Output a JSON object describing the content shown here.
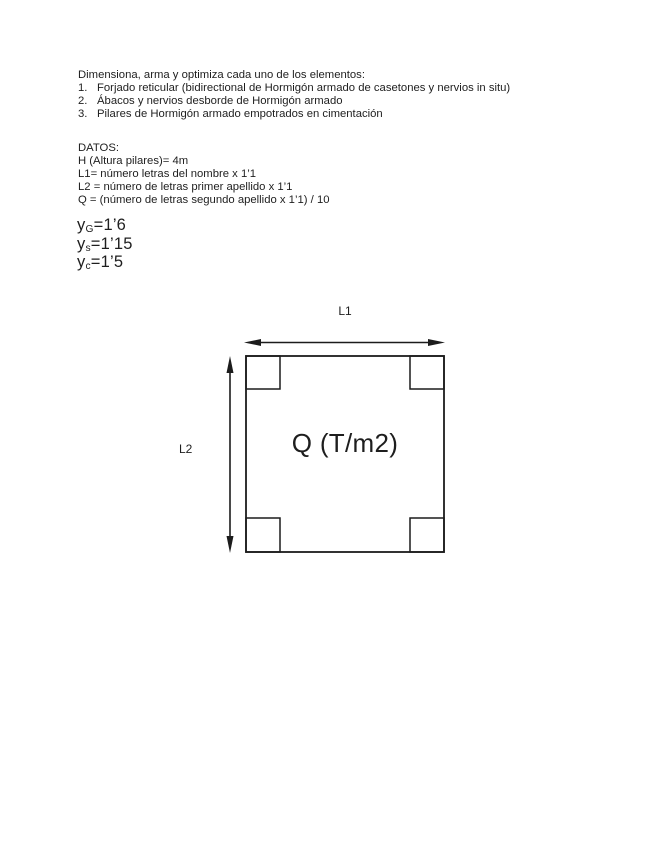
{
  "document": {
    "intro": "Dimensiona, arma y optimiza cada uno de los elementos:",
    "list": [
      {
        "marker": "1.",
        "text": "Forjado reticular (bidirectional de Hormigón armado de casetones y nervios in situ)"
      },
      {
        "marker": "2.",
        "text": "Ábacos y nervios desborde de Hormigón armado"
      },
      {
        "marker": "3.",
        "text": "Pilares de Hormigón armado empotrados en cimentación"
      }
    ],
    "datos_title": "DATOS:",
    "datos_lines": [
      "H (Altura pilares)= 4m",
      "L1= número letras del nombre x 1’1",
      "L2 = número de letras primer apellido x 1’1",
      "Q = (número de letras segundo apellido x 1’1) / 10"
    ],
    "safety_factors": [
      {
        "symbol": "y",
        "sub": "G",
        "value": "=1’6"
      },
      {
        "symbol": "y",
        "sub": "s",
        "value": "=1’15"
      },
      {
        "symbol": "y",
        "sub": "c",
        "value": "=1’5"
      }
    ],
    "diagram": {
      "top_dimension_label": "L1",
      "left_dimension_label": "L2",
      "load_label": "Q (T/m2)",
      "line_color": "#1c1c1c"
    }
  }
}
